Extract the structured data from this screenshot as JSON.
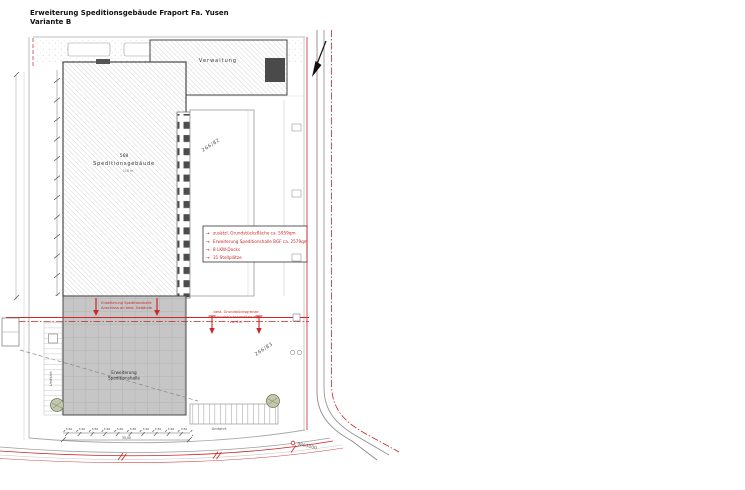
{
  "title": {
    "line1": "Erweiterung Speditionsgebäude Fraport Fa. Yusen",
    "line2": "Variante B"
  },
  "buildings": {
    "verwaltung": {
      "label": "Verwaltung"
    },
    "main": {
      "number": "568",
      "name": "Speditionsgebäude",
      "sub": "116 m"
    },
    "extension": {
      "line1": "Erweiterung",
      "line2": "Speditionshalle"
    }
  },
  "legend": {
    "items": [
      "zusätzl. Grundstücksfläche ca. 5959qm",
      "Erweiterung Speditionshalle BGF ca. 2579qm",
      "8 LKW-Docks",
      "31 Stellplätze"
    ]
  },
  "annotations": {
    "connection": {
      "line1": "Erweiterung Speditionshalle",
      "line2": "Anschluss an best. Gebäude"
    },
    "boundary": {
      "line1": "best. Grundstücksgrenze",
      "line2": "Grundstückserweiterung",
      "line3": "ca. 4m"
    }
  },
  "parcels": {
    "upper": "266/82",
    "lower": "266/83"
  },
  "roads": {
    "umfahrt_bottom": "Umfahrt",
    "umfahrt_left": "Umfahrt"
  },
  "survey": {
    "coordinate": "9863000"
  },
  "dimensions": {
    "bay": "3,50",
    "total": "35,00"
  },
  "colors": {
    "red": "#cc2626",
    "hall_gray": "#c6c6c6",
    "hatch": "#c4c4c4"
  }
}
